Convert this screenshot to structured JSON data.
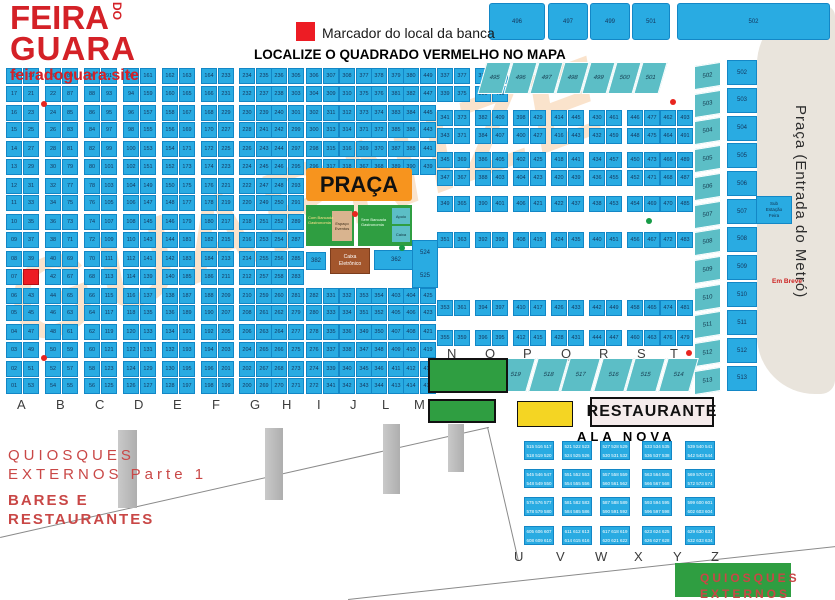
{
  "logo": {
    "l1": "FEIRA",
    "do": "DO",
    "l2": "GUARA",
    "site": "feiradoguara.site"
  },
  "legend": {
    "marker_label": "Marcador do local da banca",
    "title": "LOCALIZE O QUADRADO VERMELHO NO MAPA"
  },
  "top_blocks": [
    "496",
    "497",
    "499",
    "501",
    "502"
  ],
  "metro": {
    "label": "Praça (Entrada do Metró)",
    "note": "Em Breve"
  },
  "watermark": {
    "text": "GUARNIZE"
  },
  "main_grid": {
    "letters": [
      "A",
      "B",
      "C",
      "D",
      "E",
      "F",
      "G",
      "H",
      "I",
      "J",
      "L",
      "M"
    ],
    "gap_columns": [
      8,
      9,
      10,
      11
    ],
    "gap_rows_from": 6,
    "gap_rows_to": 11,
    "red_marker": {
      "column": 0,
      "side": "right",
      "row": 11,
      "number": "41"
    },
    "columns": [
      {
        "letter": "A",
        "left": "18 17 16 15 14 13 12 11 10 09 08 07 06 05 04 03 02 01",
        "right": "19 21 23 25 27 29 31 33 35 37 39 41 43 45 47 49 51 53"
      },
      {
        "letter": "B",
        "left": "20 22 24 26 28 30 32 34 36 38 40 42 44 46 48 50 52 54",
        "right": "89 87 85 83 81 79 77 75 73 71 69 67 65 63 61 59 57 55"
      },
      {
        "letter": "C",
        "left": "90 88 86 84 82 80 78 76 74 72 70 68 66 64 62 60 58 56",
        "right": "91 93 95 97 99 101 103 105 107 109 111 113 115 117 119 121 123 125"
      },
      {
        "letter": "D",
        "left": "92 94 96 98 100 102 104 106 108 110 112 114 116 118 120 122 124 126",
        "right": "161 159 157 155 153 151 149 147 145 143 141 139 137 135 133 131 129 127"
      },
      {
        "letter": "E",
        "left": "162 160 158 156 154 152 150 148 146 144 142 140 138 136 134 132 130 128",
        "right": "163 165 167 169 171 173 175 177 179 181 183 185 187 189 191 193 195 197"
      },
      {
        "letter": "F",
        "left": "164 166 168 170 172 174 176 178 180 182 184 186 188 190 192 194 196 198",
        "right": "233 231 229 227 225 223 221 219 217 215 213 211 209 207 205 203 201 199"
      },
      {
        "letter": "G",
        "left": "234 232 230 228 226 224 222 220 218 216 214 212 210 208 206 204 202 200",
        "right": "235 237 239 241 243 245 247 249 251 253 255 257 259 261 263 265 267 269"
      },
      {
        "letter": "H",
        "left": "236 238 240 242 244 246 248 250 252 254 256 258 260 262 264 266 268 270",
        "right": "305 303 301 299 297 295 293 291 289 287 285 283 281 279 277 275 273 271"
      },
      {
        "letter": "I",
        "left": "306 304 302 300 298 296 294 292 290 288 286 284 282 280 278 276 274 272",
        "right": "307 309 311 313 315 317 319 321 323 325 327 329 331 333 335 337 339 341"
      },
      {
        "letter": "J",
        "left": "308 310 312 314 316 318 320 322 324 326 328 330 332 334 336 338 340 342",
        "right": "377 375 373 371 369 367 365 363 361 359 357 355 353 351 349 347 345 343"
      },
      {
        "letter": "L",
        "left": "378 376 374 372 370 368 366 364 362 360 358 356 354 352 350 348 346 344",
        "right": "379 381 383 385 387 389 391 393 395 397 399 401 403 405 407 409 411 413"
      },
      {
        "letter": "M",
        "left": "380 382 384 386 388 390 392 394 396 398 400 402 404 406 408 410 412 414",
        "right": "449 447 445 443 441 439 437 435 433 431 429 427 425 423 421 419 417 415"
      }
    ]
  },
  "right_grid": {
    "letters": [
      "N",
      "O",
      "P",
      "Q",
      "R",
      "S",
      "T"
    ],
    "columns": [
      {
        "letter": "N",
        "left": "337 339 341 343 345 347 349 351 353 355",
        "right": "377 375 373 371 369 367 365 363 361 359"
      },
      {
        "letter": "O",
        "left": "378 380 382 384 386 388 390 392 394 396",
        "right": "413 411 409 407 405 403 401 399 397 395"
      },
      {
        "letter": "P",
        "left": "398 400 402 404 406 408 410 412",
        "right": "429 427 425 423 421 419 417 415"
      },
      {
        "letter": "Q",
        "left": "414 416 418 420 422 424 426 428",
        "right": "445 443 441 439 437 435 433 431"
      },
      {
        "letter": "R",
        "left": "430 432 434 436 438 440 442 444",
        "right": "461 459 457 455 453 451 449 447"
      },
      {
        "letter": "S",
        "left": "446 448 450 452 454 456 458 460",
        "right": "477 475 473 471 469 467 465 463"
      },
      {
        "letter": "T",
        "left": "462 464 466 468 470 472 474 476",
        "right": "493 491 489 487 485 483 481 479"
      }
    ]
  },
  "trap_top": [
    "495",
    "496",
    "497",
    "498",
    "499",
    "500",
    "501"
  ],
  "side_teal": [
    "502",
    "503",
    "504",
    "505",
    "506",
    "507",
    "508",
    "509",
    "510",
    "511",
    "512",
    "513"
  ],
  "side_blue": [
    "502",
    "503",
    "504",
    "505",
    "506",
    "507",
    "508",
    "509",
    "510",
    "511",
    "512",
    "513"
  ],
  "trap_mid": [
    "519",
    "518",
    "517",
    "516",
    "515",
    "514"
  ],
  "praca": {
    "label": "PRAÇA",
    "g1": [
      "Com Bancada",
      "Gastronomia"
    ],
    "g1tan": [
      "Espaço",
      "Eventos"
    ],
    "g2": [
      "Sem Bancada",
      "Gastronomia"
    ],
    "g2a": "Apoio",
    "g2b": "Caixa",
    "b382": "382",
    "caixa": [
      "Caixa",
      "Eletrônico"
    ],
    "b362": "362",
    "tall": [
      "524",
      "525"
    ],
    "sub": [
      "Sub",
      "Estação",
      "Feira"
    ]
  },
  "restaurante": {
    "label": "RESTAURANTE"
  },
  "ala_nova": {
    "title": "ALA NOVA",
    "letters": [
      "U",
      "V",
      "W",
      "X",
      "Y",
      "Z"
    ],
    "blocks": [
      [
        "515 516 517",
        "518 519 520"
      ],
      [
        "521 522 523",
        "524 525 526"
      ],
      [
        "527 528 529",
        "530 531 532"
      ],
      [
        "533 534 535",
        "536 537 538"
      ],
      [
        "539 540 541",
        "542 543 544"
      ],
      [
        "545 546 547",
        "548 549 550"
      ],
      [
        "551 552 553",
        "554 555 556"
      ],
      [
        "557 558 559",
        "560 561 562"
      ],
      [
        "563 564 565",
        "566 567 568"
      ],
      [
        "569 570 571",
        "572 573 574"
      ],
      [
        "575 576 577",
        "578 579 580"
      ],
      [
        "581 582 583",
        "584 585 586"
      ],
      [
        "587 588 589",
        "590 591 592"
      ],
      [
        "593 594 595",
        "596 597 598"
      ],
      [
        "599 600 601",
        "602 603 604"
      ],
      [
        "605 606 607",
        "608 609 610"
      ],
      [
        "611 612 613",
        "614 615 616"
      ],
      [
        "617 618 619",
        "620 621 622"
      ],
      [
        "623 624 625",
        "626 627 628"
      ],
      [
        "629 630 631",
        "632 633 634"
      ]
    ]
  },
  "quiosques1": {
    "l1": "QUIOSQUES",
    "l2": "EXTERNOS Parte 1"
  },
  "bares": {
    "l1": "BARES E",
    "l2": "RESTAURANTES"
  },
  "quiosques2": {
    "l1": "QUIOSQUES",
    "l2": "EXTERNOS Parte 2"
  },
  "dots": [
    {
      "x": 41,
      "y": 101,
      "c": "#e8251f"
    },
    {
      "x": 41,
      "y": 355,
      "c": "#e8251f"
    },
    {
      "x": 670,
      "y": 99,
      "c": "#e8251f"
    },
    {
      "x": 686,
      "y": 350,
      "c": "#e8251f"
    },
    {
      "x": 352,
      "y": 211,
      "c": "#e8251f"
    },
    {
      "x": 399,
      "y": 245,
      "c": "#169b46"
    },
    {
      "x": 646,
      "y": 218,
      "c": "#169b46"
    }
  ],
  "colors": {
    "stall_blue": "#29abe2",
    "teal": "#5cbec6",
    "red": "#ed1c24",
    "orange": "#f7941e",
    "green": "#2f9e41",
    "yellow": "#f4d523",
    "gray_area": "#e9e4dc",
    "brown": "#a3562c",
    "watermark": "#f5bd88",
    "logo_red": "#d42127",
    "text_red": "#c94746"
  }
}
